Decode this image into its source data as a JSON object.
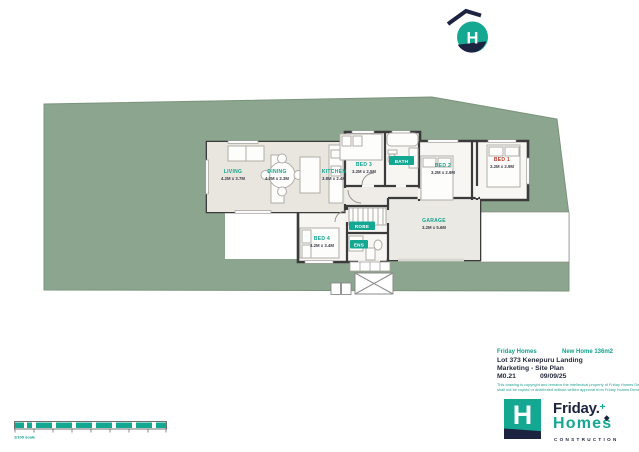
{
  "brand": {
    "monogram": "H",
    "word1": "Friday.",
    "plus": "+",
    "word2": "Homes",
    "tagline": "CONSTRUCTION",
    "teal": "#14a893",
    "navy": "#1c2340"
  },
  "plan": {
    "site_color": "#8ca58e",
    "wall_color": "#3b3b3b",
    "rooms": [
      {
        "name": "LIVING",
        "dims": "4.2M x 3.7M"
      },
      {
        "name": "DINING",
        "dims": "4.2M x 2.3M"
      },
      {
        "name": "KITCHEN",
        "dims": "3.8M x 2.4M"
      },
      {
        "name": "BED 3",
        "dims": "3.2M x 2.5M"
      },
      {
        "name": "BATH",
        "dims": ""
      },
      {
        "name": "BED 2",
        "dims": "3.2M x 2.9M"
      },
      {
        "name": "BED 1",
        "dims": "3.2M x 2.9M"
      },
      {
        "name": "BED 4",
        "dims": "3.2M x 3.4M"
      },
      {
        "name": "ROBE",
        "dims": ""
      },
      {
        "name": "ENS",
        "dims": ""
      },
      {
        "name": "GARAGE",
        "dims": "3.2M x 5.6M"
      }
    ]
  },
  "scalebar": {
    "label": "1/100 scale"
  },
  "titleblock": {
    "company": "Friday Homes",
    "project": "New Home 136m2",
    "lot": "Lot 373 Kenepuru Landing",
    "sheet": "Marketing - Site Plan",
    "number": "M0.21",
    "date": "09/09/25",
    "disclaimer1": "This drawing is copyright and remains the intellectual property of Friday Homes Development and",
    "disclaimer2": "shall not be copied or distributed without written approval from Friday Homes Development"
  }
}
